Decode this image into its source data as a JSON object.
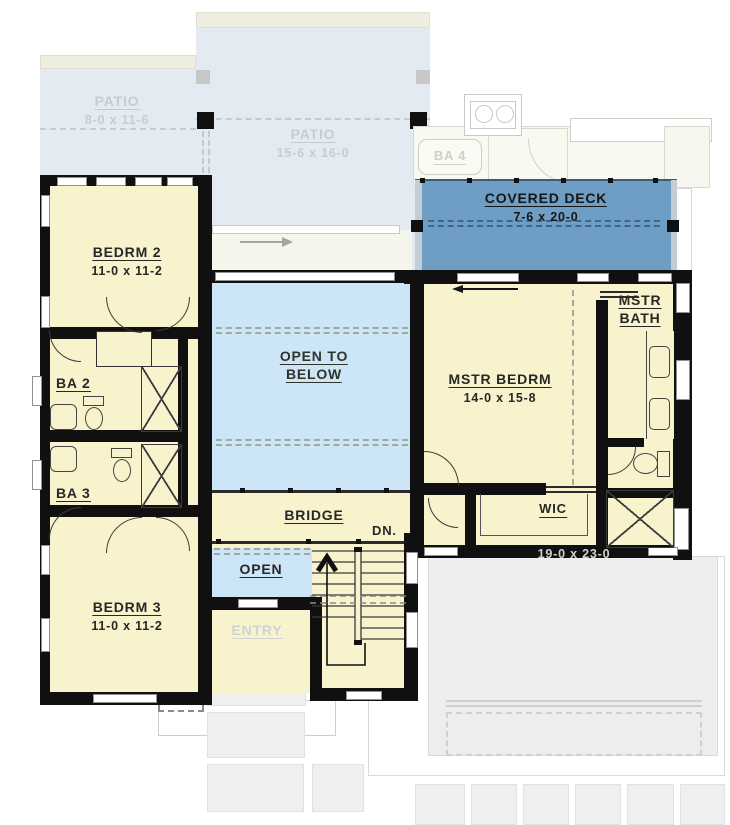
{
  "title": "Second floor plan",
  "colors": {
    "wall": "#101010",
    "room_cream": "#f8f3cd",
    "open_blue": "#cde6f7",
    "deck_blue": "#6f9ec5",
    "patio_faded": "#e3eaf2",
    "garage_gray": "#ededee"
  },
  "rooms": {
    "patio_left": {
      "label": "PATIO",
      "dims": "8-0 x 11-6"
    },
    "patio_center": {
      "label": "PATIO",
      "dims": "15-6 x 16-0"
    },
    "ba4": {
      "label": "BA 4"
    },
    "covered_deck": {
      "label": "COVERED DECK",
      "dims": "7-6 x 20-0"
    },
    "mstr_bath": {
      "line1": "MSTR",
      "line2": "BATH"
    },
    "mstr_bedrm": {
      "label": "MSTR BEDRM",
      "dims": "14-0 x 15-8"
    },
    "bedrm2": {
      "label": "BEDRM 2",
      "dims": "11-0 x 11-2"
    },
    "ba2": {
      "label": "BA 2"
    },
    "ba3": {
      "label": "BA 3"
    },
    "bedrm3": {
      "label": "BEDRM 3",
      "dims": "11-0 x 11-2"
    },
    "open_below": {
      "line1": "OPEN TO",
      "line2": "BELOW"
    },
    "bridge": {
      "label": "BRIDGE"
    },
    "open": {
      "label": "OPEN"
    },
    "wic": {
      "label": "WIC"
    },
    "entry": {
      "label": "ENTRY"
    },
    "stairs": {
      "down_label": "DN."
    },
    "garage": {
      "dims": "19-0 x 23-0"
    }
  }
}
